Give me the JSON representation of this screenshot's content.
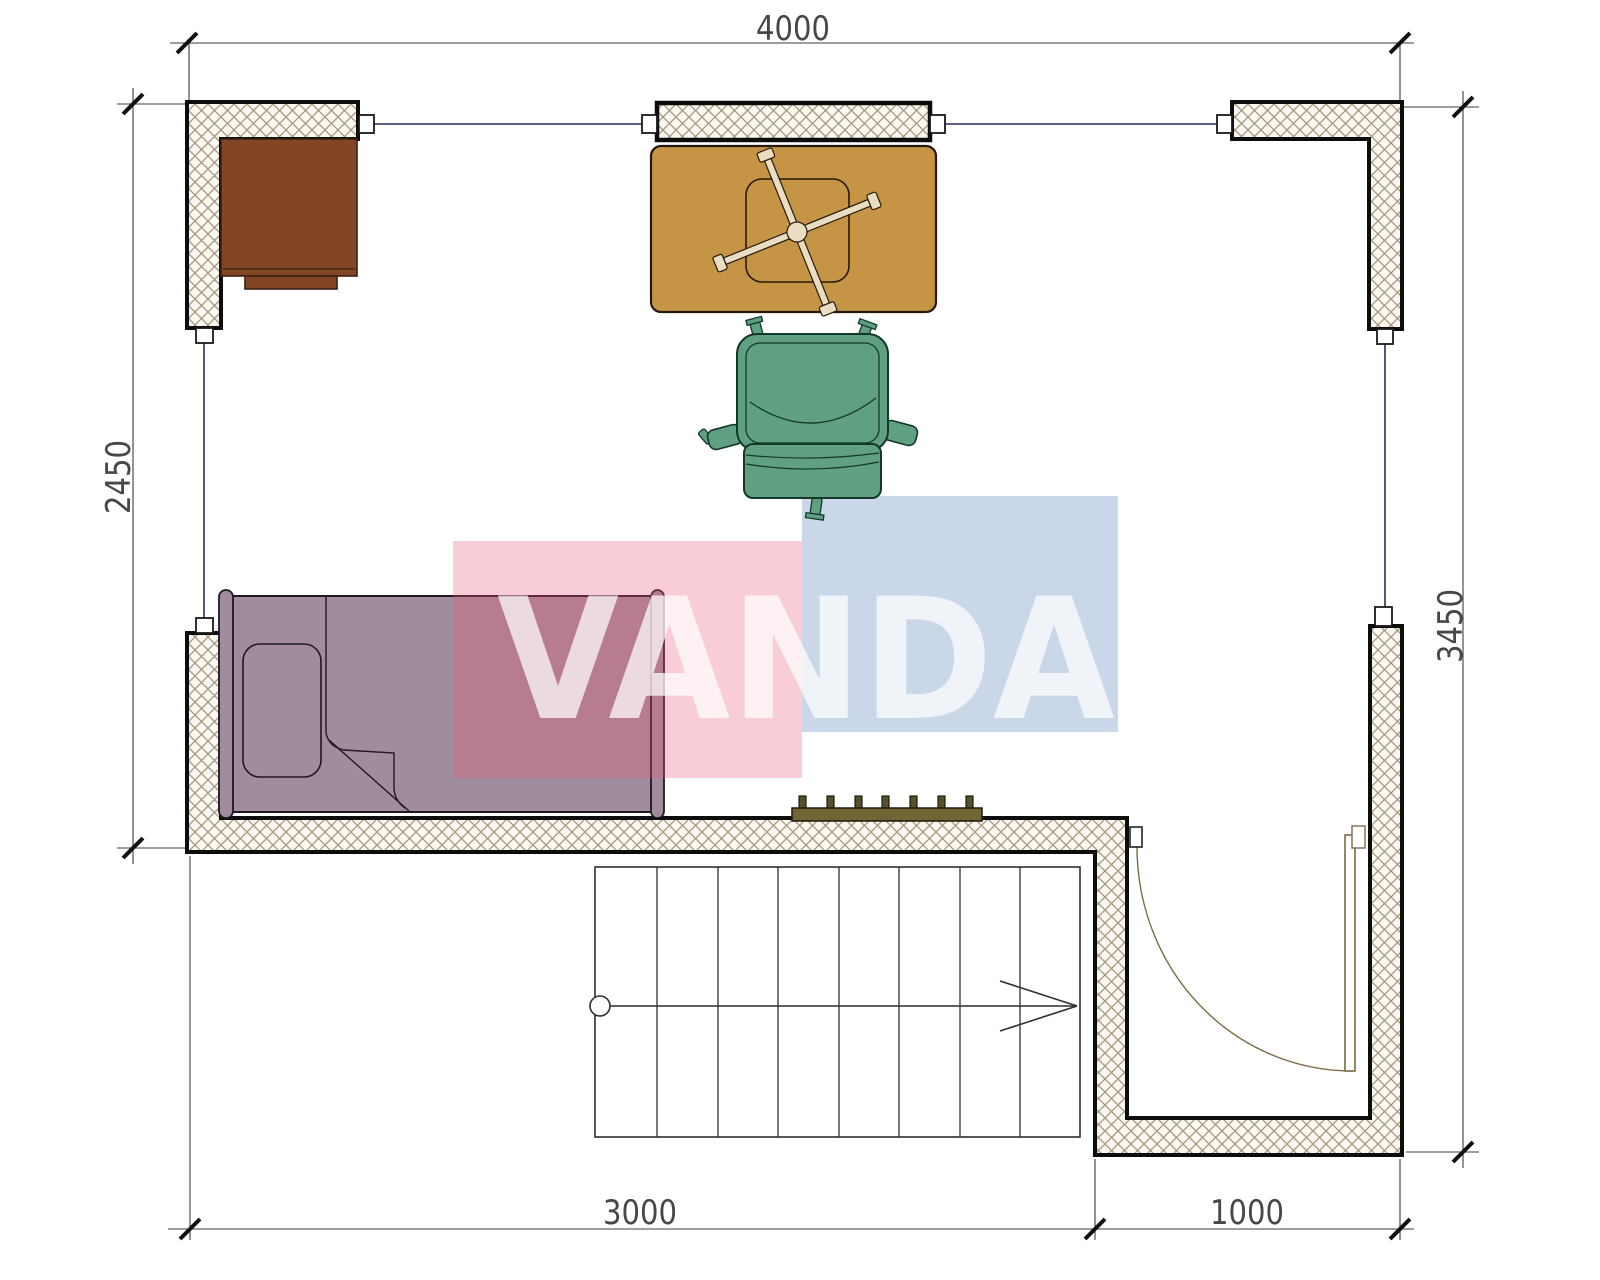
{
  "document": {
    "kind": "architectural-floor-plan"
  },
  "watermark": {
    "text": "VANDA",
    "pink": "rgba(236,90,115,0.30)",
    "blue": "rgba(90,135,185,0.33)",
    "text_color": "rgba(255,255,255,0.72)"
  },
  "dimensions": {
    "top": "4000",
    "left": "2450",
    "right": "3450",
    "bottom_left": "3000",
    "bottom_right": "1000"
  },
  "colors": {
    "desk": "#824627",
    "table": "#c59445",
    "table_base": "#e9dec2",
    "chair": "#5fa083",
    "bed": "#a18c9d",
    "radiator_body": "#6f6535",
    "radiator_fin": "#56512c",
    "door": "#7b6b46",
    "window_line": "#2b2b58",
    "wall_stroke": "#0d0d0d",
    "hatch_line": "#a2947a",
    "hatch_bg": "#fbf8f1",
    "dim_line": "#3c3c3c"
  }
}
